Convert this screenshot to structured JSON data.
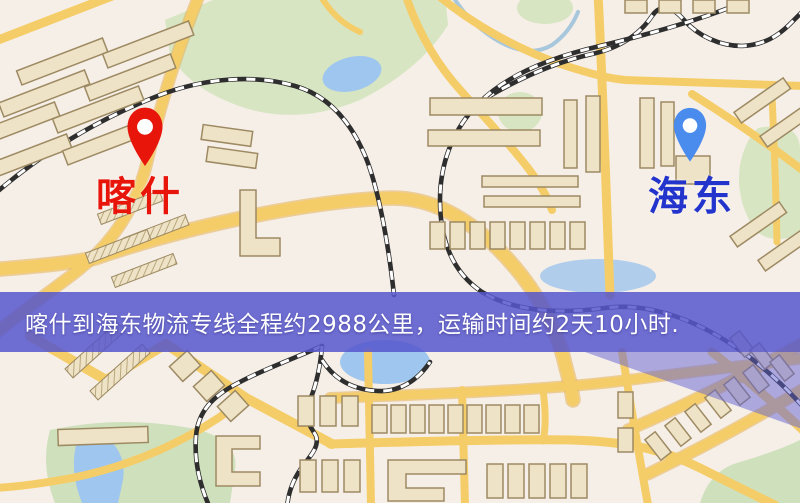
{
  "banner": {
    "text": "喀什到海东物流专线全程约2988公里，运输时间约2天10小时."
  },
  "origin": {
    "name": "喀什"
  },
  "destination": {
    "name": "海东"
  },
  "route": {
    "distance_text": "约2988公里",
    "duration_text": "约2天10小时"
  },
  "colors": {
    "background": "#f6efe7",
    "road": "#f5cd68",
    "road_casing": "#e4b158",
    "park": "#d7e5c2",
    "water": "#9fc6ee",
    "building": "#eee3c6",
    "building_edge": "#9d8a63",
    "rail_dark": "#2e2e2e",
    "rail_light": "#ffffff",
    "banner_bg": "rgba(86,86,205,0.85)",
    "banner_text": "#ffffff",
    "origin_color": "#e8150b",
    "dest_marker": "#4a8ced",
    "dest_label": "#2334cc",
    "overlay_wedge": "rgba(97,97,212,0.5)"
  }
}
